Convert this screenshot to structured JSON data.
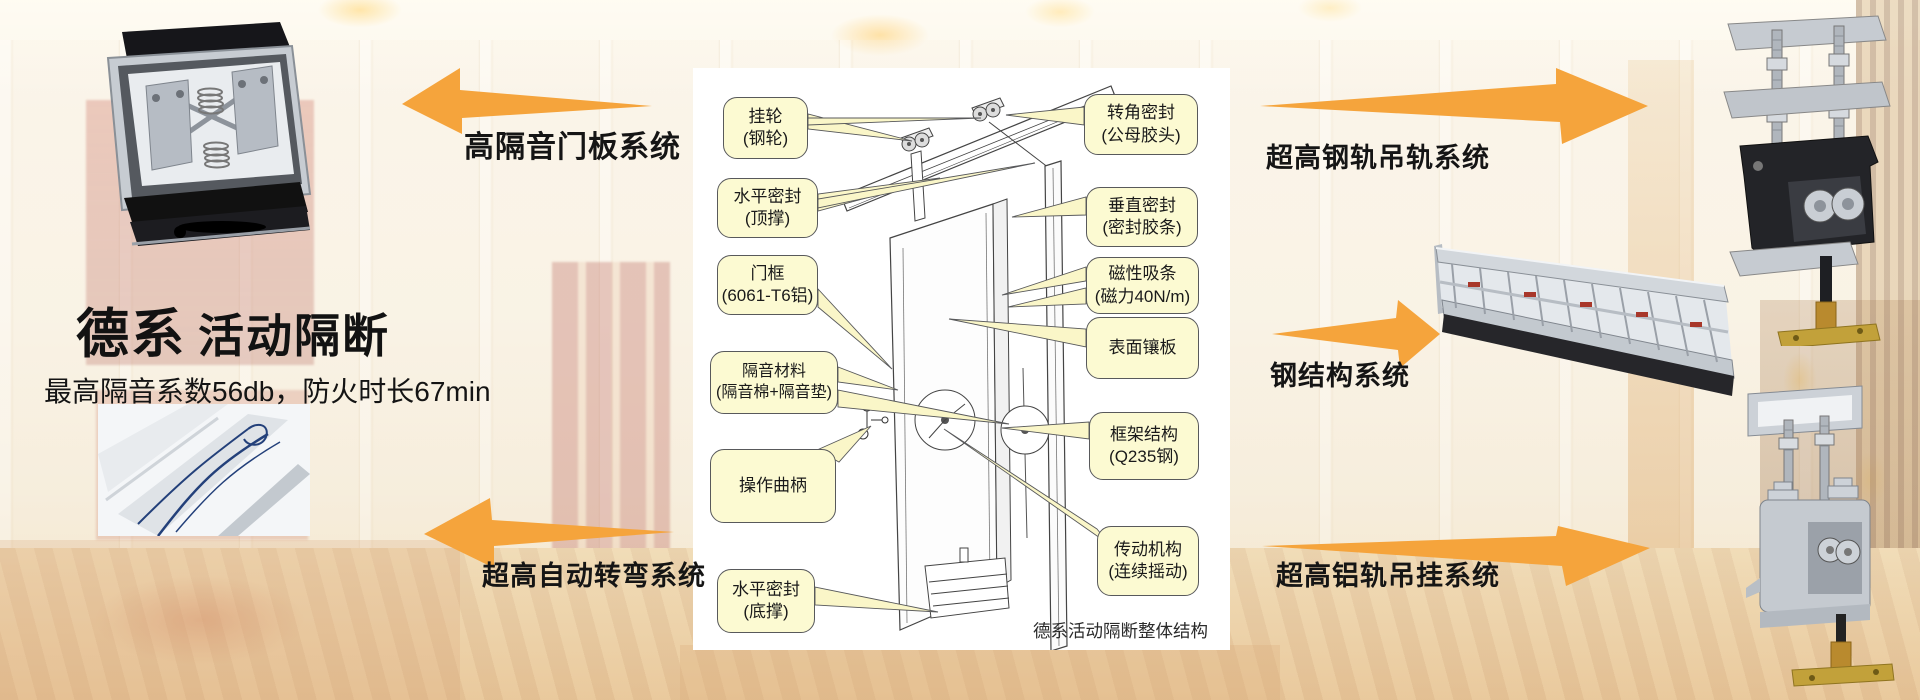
{
  "header": {
    "title_primary": "德系",
    "title_secondary": "活动隔断",
    "subtitle": "最高隔音系数56db，防火时长67min"
  },
  "system_labels": {
    "top_left": "高隔音门板系统",
    "bottom_left": "超高自动转弯系统",
    "top_right": "超高钢轨吊轨系统",
    "mid_right": "钢结构系统",
    "bottom_right": "超高铝轨吊挂系统"
  },
  "diagram": {
    "caption": "德系活动隔断整体结构",
    "callouts_left": [
      {
        "line1": "挂轮",
        "line2": "(钢轮)"
      },
      {
        "line1": "水平密封",
        "line2": "(顶撑)"
      },
      {
        "line1": "门框",
        "line2": "(6061-T6铝)"
      },
      {
        "line1": "隔音材料",
        "line2": "(隔音棉+隔音垫)"
      },
      {
        "line1": "操作曲柄",
        "line2": ""
      },
      {
        "line1": "水平密封",
        "line2": "(底撑)"
      }
    ],
    "callouts_right": [
      {
        "line1": "转角密封",
        "line2": "(公母胶头)"
      },
      {
        "line1": "垂直密封",
        "line2": "(密封胶条)"
      },
      {
        "line1": "磁性吸条",
        "line2": "(磁力40N/m)"
      },
      {
        "line1": "表面镶板",
        "line2": ""
      },
      {
        "line1": "框架结构",
        "line2": "(Q235钢)"
      },
      {
        "line1": "传动机构",
        "line2": "(连续摇动)"
      }
    ]
  },
  "photos": [
    {
      "name": "door-panel-cross-section-photo"
    },
    {
      "name": "curved-track-profile-photo"
    },
    {
      "name": "steel-rail-trolley-photo"
    },
    {
      "name": "steel-structure-frame-photo"
    },
    {
      "name": "aluminum-rail-trolley-photo"
    }
  ],
  "colors": {
    "arrow_orange": "#F5A43C",
    "callout_fill": "#FCFAD2",
    "callout_border": "#58595B",
    "diagram_bg": "#FFFFFF"
  }
}
